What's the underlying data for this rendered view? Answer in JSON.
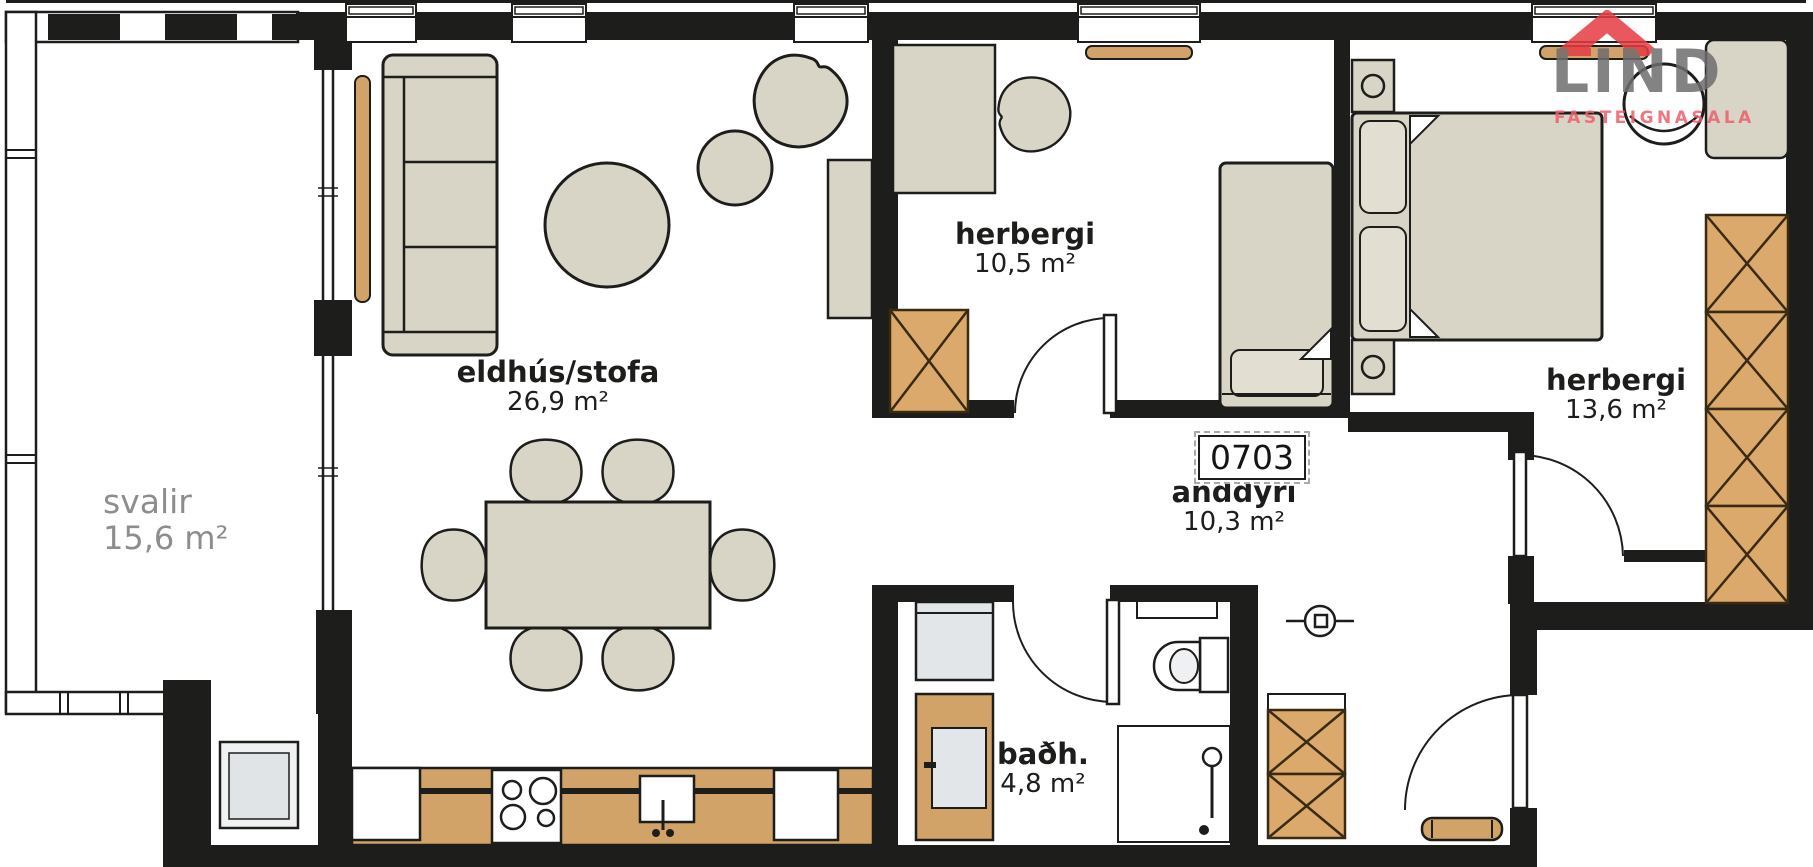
{
  "plan": {
    "unit_number": "0703",
    "rooms": [
      {
        "id": "svalir",
        "name": "svalir",
        "area": "15,6 m²"
      },
      {
        "id": "eldhus_stofa",
        "name": "eldhús/stofa",
        "area": "26,9 m²"
      },
      {
        "id": "herbergi_1",
        "name": "herbergi",
        "area": "10,5 m²"
      },
      {
        "id": "herbergi_2",
        "name": "herbergi",
        "area": "13,6 m²"
      },
      {
        "id": "anddyri",
        "name": "anddyri",
        "area": "10,3 m²"
      },
      {
        "id": "badherbergi",
        "name": "baðh.",
        "area": "4,8 m²"
      }
    ]
  },
  "logo": {
    "name": "LIND",
    "subtitle": "FASTEIGNASALA",
    "house_icon": "house-icon"
  },
  "colors": {
    "wall": "#1d1d1b",
    "furniture": "#d8d5c6",
    "wood": "#d2a368",
    "wardrobe": "#dba96b",
    "appliance": "#e2e6e8",
    "muted_label": "#8d8d8d",
    "logo_gray": "#6f6e6e",
    "logo_red": "#e73c44",
    "logo_pink": "#ee5e6b"
  }
}
